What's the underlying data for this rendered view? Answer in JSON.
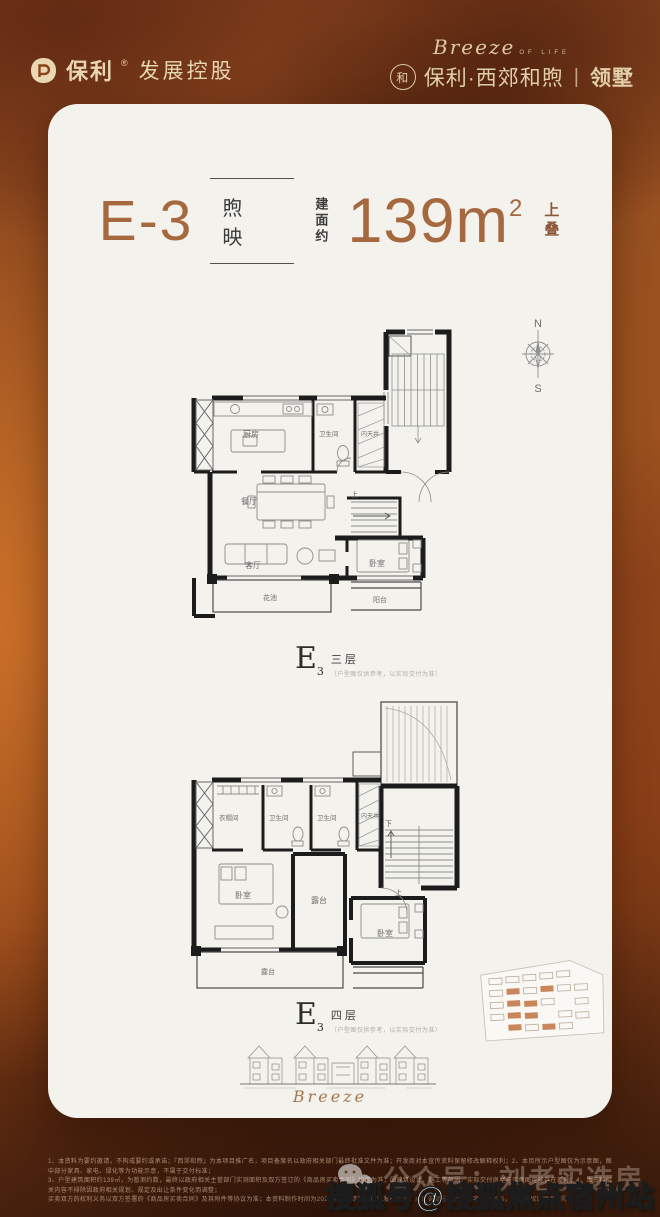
{
  "header": {
    "brand": "保利",
    "brand_reg": "®",
    "brand_suffix": "发展控股",
    "script": "Breeze",
    "script_sub": "OF LIFE",
    "seal_glyph": "和",
    "project_name": "保利·西郊和煦",
    "divider": "|",
    "project_suffix": "领墅"
  },
  "title": {
    "unit": "E-3",
    "house_name": "煦映",
    "area_label": "建面约",
    "area_value": "139m",
    "area_sup": "2",
    "area_tag": "上叠"
  },
  "compass": {
    "north": "N",
    "south": "S"
  },
  "plan1": {
    "letter": "E",
    "letter_sub": "3",
    "floor": "三层",
    "note": "（户型图仅供参考，以实际交付为准）",
    "rooms": {
      "kitchen": "厨房",
      "bath": "卫生间",
      "lightwell": "内天井",
      "dining": "餐厅",
      "living": "客厅",
      "bedroom": "卧室",
      "balcony": "阳台",
      "garden": "花池",
      "up": "上"
    }
  },
  "plan2": {
    "letter": "E",
    "letter_sub": "3",
    "floor": "四层",
    "note": "（户型图仅供参考，以实际交付为准）",
    "rooms": {
      "cloak": "衣帽间",
      "bath1": "卫生间",
      "bath2": "卫生间",
      "lightwell": "内天井",
      "bedroom1": "卧室",
      "terrace1": "露台",
      "bedroom2": "卧室",
      "terrace2": "露台",
      "up": "上",
      "down": "下"
    }
  },
  "footer_script": "Breeze",
  "disclaimer": {
    "line1": "1、本资料为要约邀请，不构成要约或承诺；『西郊和煦』为本项目推广名，项目备案名以政府相关部门最终批准文件为准；开发商对本宣传资料保留修改解释权利；2、本页所示户型图仅为示意图，图中部分家具、家电、绿化等为功能示意，不属于交付标准；",
    "line2": "3、户型建筑面积约139㎡，为暂测约数，最终以政府相关主管部门实测面积及双方签订的《商品房买卖合同》约定为准；因建筑设计、施工等原因，实际交付房屋与示意图可能存在差异；4、本资料相关内容不排除因政府相关规划、规定及出让条件变化而调整；",
    "line3": "买卖双方的权利义务以双方签署的《商品房买卖合同》及其附件等协议为准；本资料制作时间为2023年，敬请留意最新发布信息；本广告部分图片及文字源于网络，如有侵权请联系删除。"
  },
  "watermarks": {
    "faint": "公众号：刘老实选房",
    "bold": "搜狐号@搜狐焦点宿州站"
  }
}
